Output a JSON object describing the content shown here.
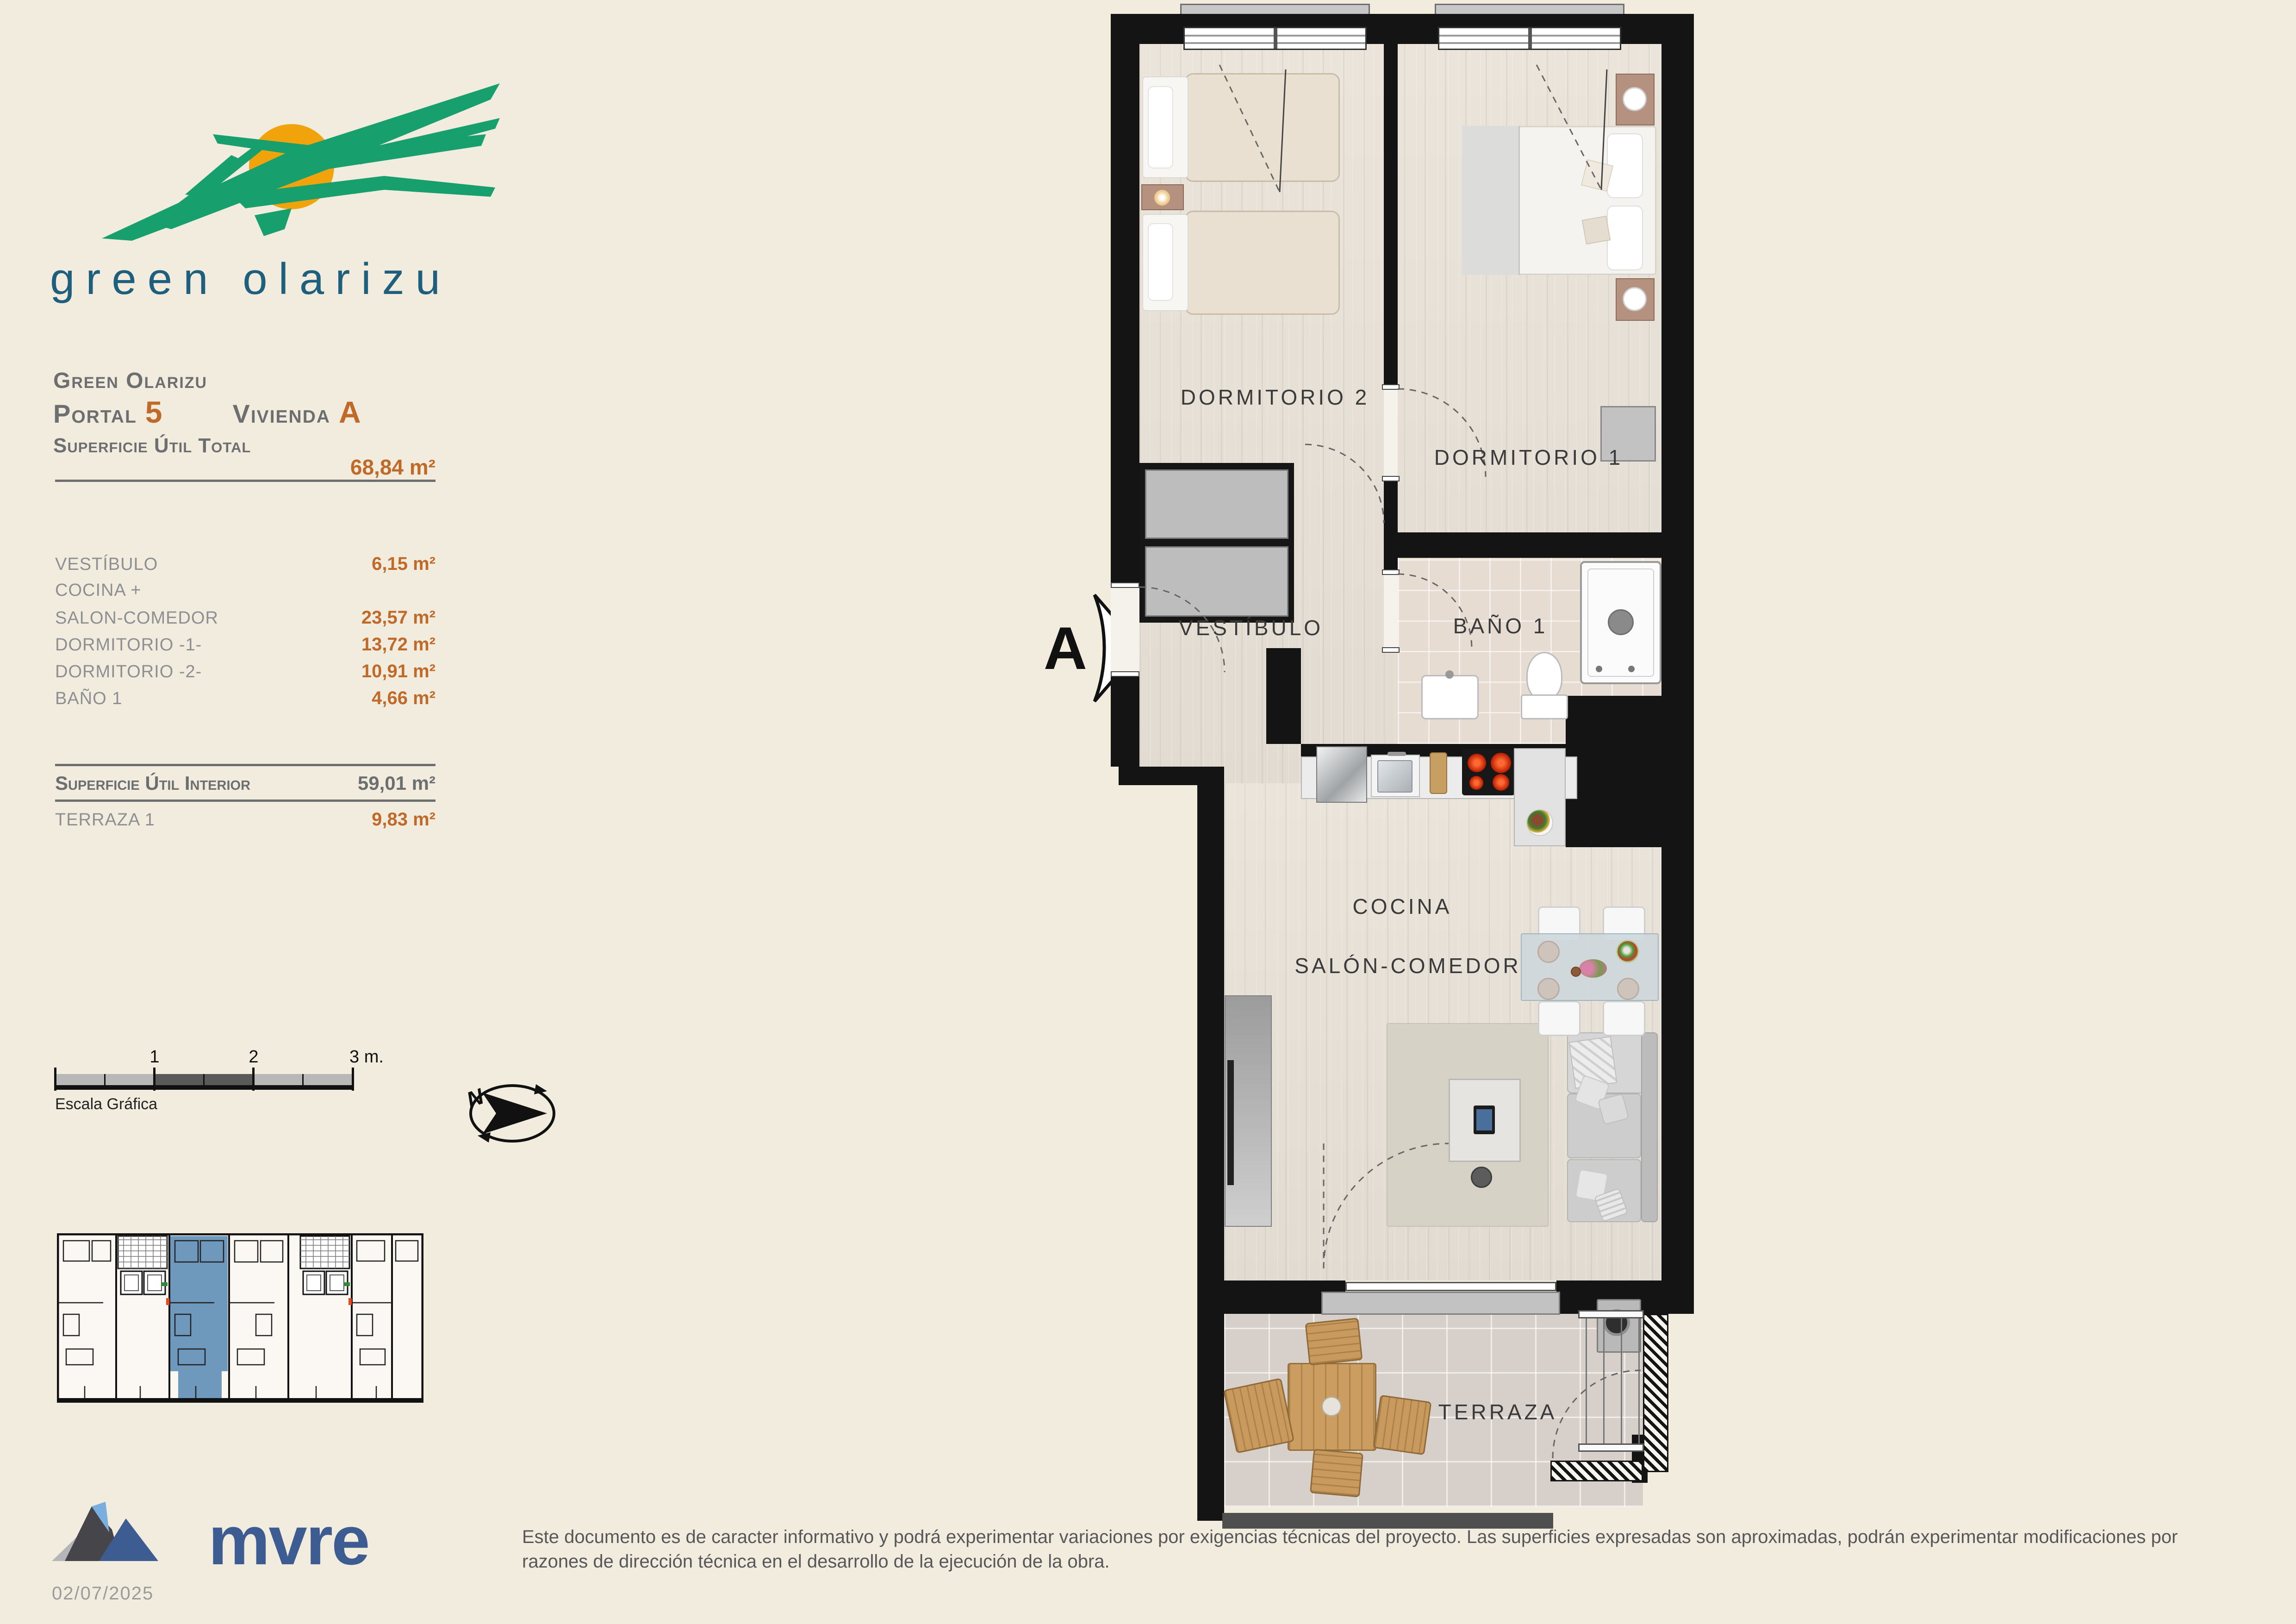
{
  "logo": {
    "brand": "green olarizu"
  },
  "info": {
    "project": "Green Olarizu",
    "portal_word": "Portal",
    "portal_number": "5",
    "vivienda_word": "Vivienda",
    "vivienda_letter": "A",
    "total_label": "Superficie Útil Total",
    "total_value": "68,84 m²",
    "rooms": [
      {
        "label": "VESTÍBULO",
        "value": "6,15 m²"
      },
      {
        "label": "COCINA +",
        "value": ""
      },
      {
        "label": "SALON-COMEDOR",
        "value": "23,57 m²"
      },
      {
        "label": "DORMITORIO -1-",
        "value": "13,72 m²"
      },
      {
        "label": "DORMITORIO -2-",
        "value": "10,91 m²"
      },
      {
        "label": "BAÑO 1",
        "value": "4,66 m²"
      }
    ],
    "interior_label": "Superficie Útil Interior",
    "interior_value": "59,01 m²",
    "terraza_label": "TERRAZA 1",
    "terraza_value": "9,83 m²"
  },
  "scale_bar": {
    "tick1": "1",
    "tick2": "2",
    "tick3": "3 m.",
    "caption": "Escala Gráfica"
  },
  "compass": {
    "north": "N"
  },
  "plan": {
    "section_marker": "A",
    "labels": {
      "dormitorio2": "DORMITORIO 2",
      "dormitorio1": "DORMITORIO 1",
      "vestibulo": "VESTÍBULO",
      "bano": "BAÑO 1",
      "cocina": "COCINA",
      "salon": "SALÓN-COMEDOR",
      "terraza": "TERRAZA"
    }
  },
  "footer": {
    "brand": "mvre",
    "date": "02/07/2025",
    "disclaimer_line1": "Este documento es de caracter informativo y podrá experimentar variaciones por exigencias técnicas del proyecto. Las superficies expresadas son aproximadas, podrán experimentar modificaciones por",
    "disclaimer_line2": "razones de dirección técnica en el desarrollo de la ejecución de la obra."
  },
  "colors": {
    "accent_orange": "#c06a2a",
    "heading_gray": "#6d6e70",
    "room_gray": "#8d8f92",
    "brand_green": "#17a06d",
    "brand_teal": "#1e5f7d",
    "brand_sun": "#f0a30a",
    "highlight_blue": "#6f98bd",
    "mvre_blue": "#3d5c92",
    "wall_black": "#141414",
    "page_cream": "#f2ecdf"
  }
}
